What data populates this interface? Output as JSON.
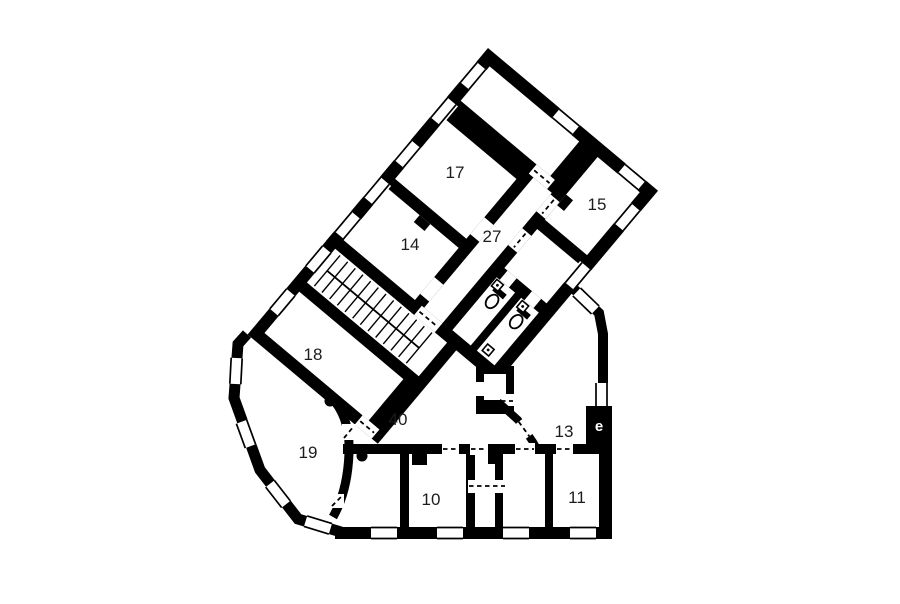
{
  "plan": {
    "background": "#ffffff",
    "wall_color": "#000000",
    "label_color": "#1c1c1c",
    "elevator_text_color": "#ffffff",
    "rooms": {
      "r17": {
        "label": "17"
      },
      "r14": {
        "label": "14"
      },
      "r27": {
        "label": "27"
      },
      "r15": {
        "label": "15"
      },
      "r18": {
        "label": "18"
      },
      "r19": {
        "label": "19"
      },
      "r40": {
        "label": "40"
      },
      "r13": {
        "label": "13"
      },
      "r10": {
        "label": "10"
      },
      "r11": {
        "label": "11"
      }
    },
    "elevator": {
      "label": "e"
    },
    "icons": {
      "toilet": "toilet-icon",
      "sink": "sink-icon",
      "column": "column-dot-icon",
      "window": "window-symbol",
      "door": "door-opening-symbol"
    }
  }
}
